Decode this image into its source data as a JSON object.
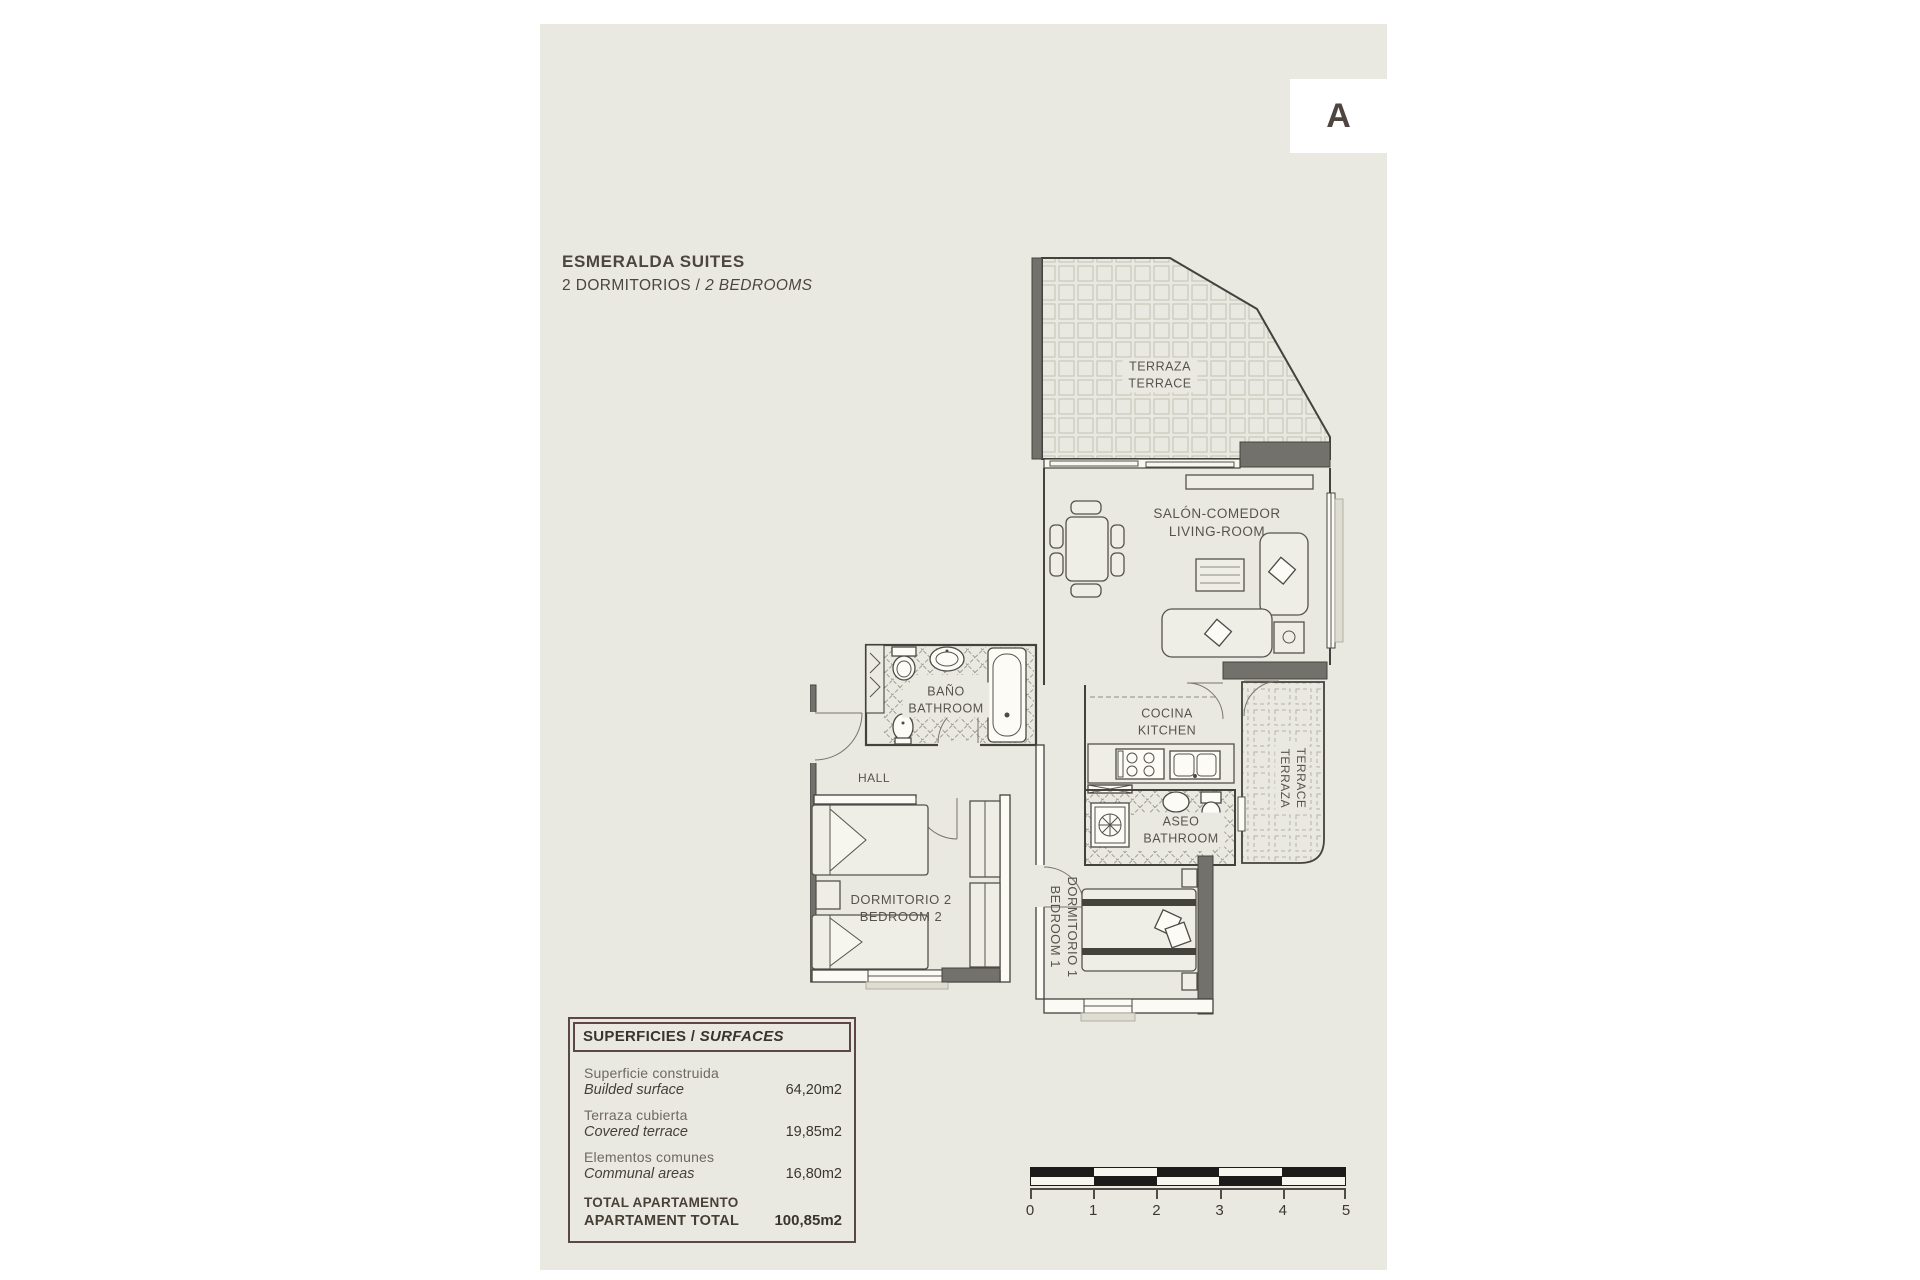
{
  "badge": {
    "letter": "A"
  },
  "title": {
    "line1": "ESMERALDA SUITES",
    "line2_es": "2 DORMITORIOS",
    "line2_sep": " / ",
    "line2_en": "2 BEDROOMS"
  },
  "rooms": {
    "terrace_top": {
      "es": "TERRAZA",
      "en": "TERRACE"
    },
    "living": {
      "es": "SALÓN-COMEDOR",
      "en": "LIVING-ROOM"
    },
    "kitchen": {
      "es": "COCINA",
      "en": "KITCHEN"
    },
    "bath_main": {
      "es": "BAÑO",
      "en": "BATHROOM"
    },
    "bath_small": {
      "es": "ASEO",
      "en": "BATHROOM"
    },
    "hall": {
      "label": "HALL"
    },
    "bedroom2": {
      "es": "DORMITORIO 2",
      "en": "BEDROOM 2"
    },
    "bedroom1": {
      "es": "DORMITORIO 1",
      "en": "BEDROOM 1"
    },
    "terrace_side": {
      "es": "TERRAZA",
      "en": "TERRACE"
    }
  },
  "surfaces": {
    "header_es": "SUPERFICIES",
    "header_sep": " / ",
    "header_en": "SURFACES",
    "rows": [
      {
        "label_es": "Superficie construida",
        "label_en": "Builded surface",
        "value": "64,20m2"
      },
      {
        "label_es": "Terraza cubierta",
        "label_en": "Covered terrace",
        "value": "19,85m2"
      },
      {
        "label_es": "Elementos comunes",
        "label_en": "Communal areas",
        "value": "16,80m2"
      }
    ],
    "total": {
      "label_es": "TOTAL APARTAMENTO",
      "label_en": "APARTAMENT TOTAL",
      "value": "100,85m2"
    }
  },
  "scale": {
    "ticks": [
      "0",
      "1",
      "2",
      "3",
      "4",
      "5"
    ]
  },
  "colors": {
    "page_bg": "#eae9e1",
    "accent_text": "#4c4540",
    "table_border": "#5c4646",
    "wall": "#44423d",
    "wall_fill": "#72716c",
    "tile_line": "#c9c8bb",
    "scale_dark": "#1c1b19"
  }
}
